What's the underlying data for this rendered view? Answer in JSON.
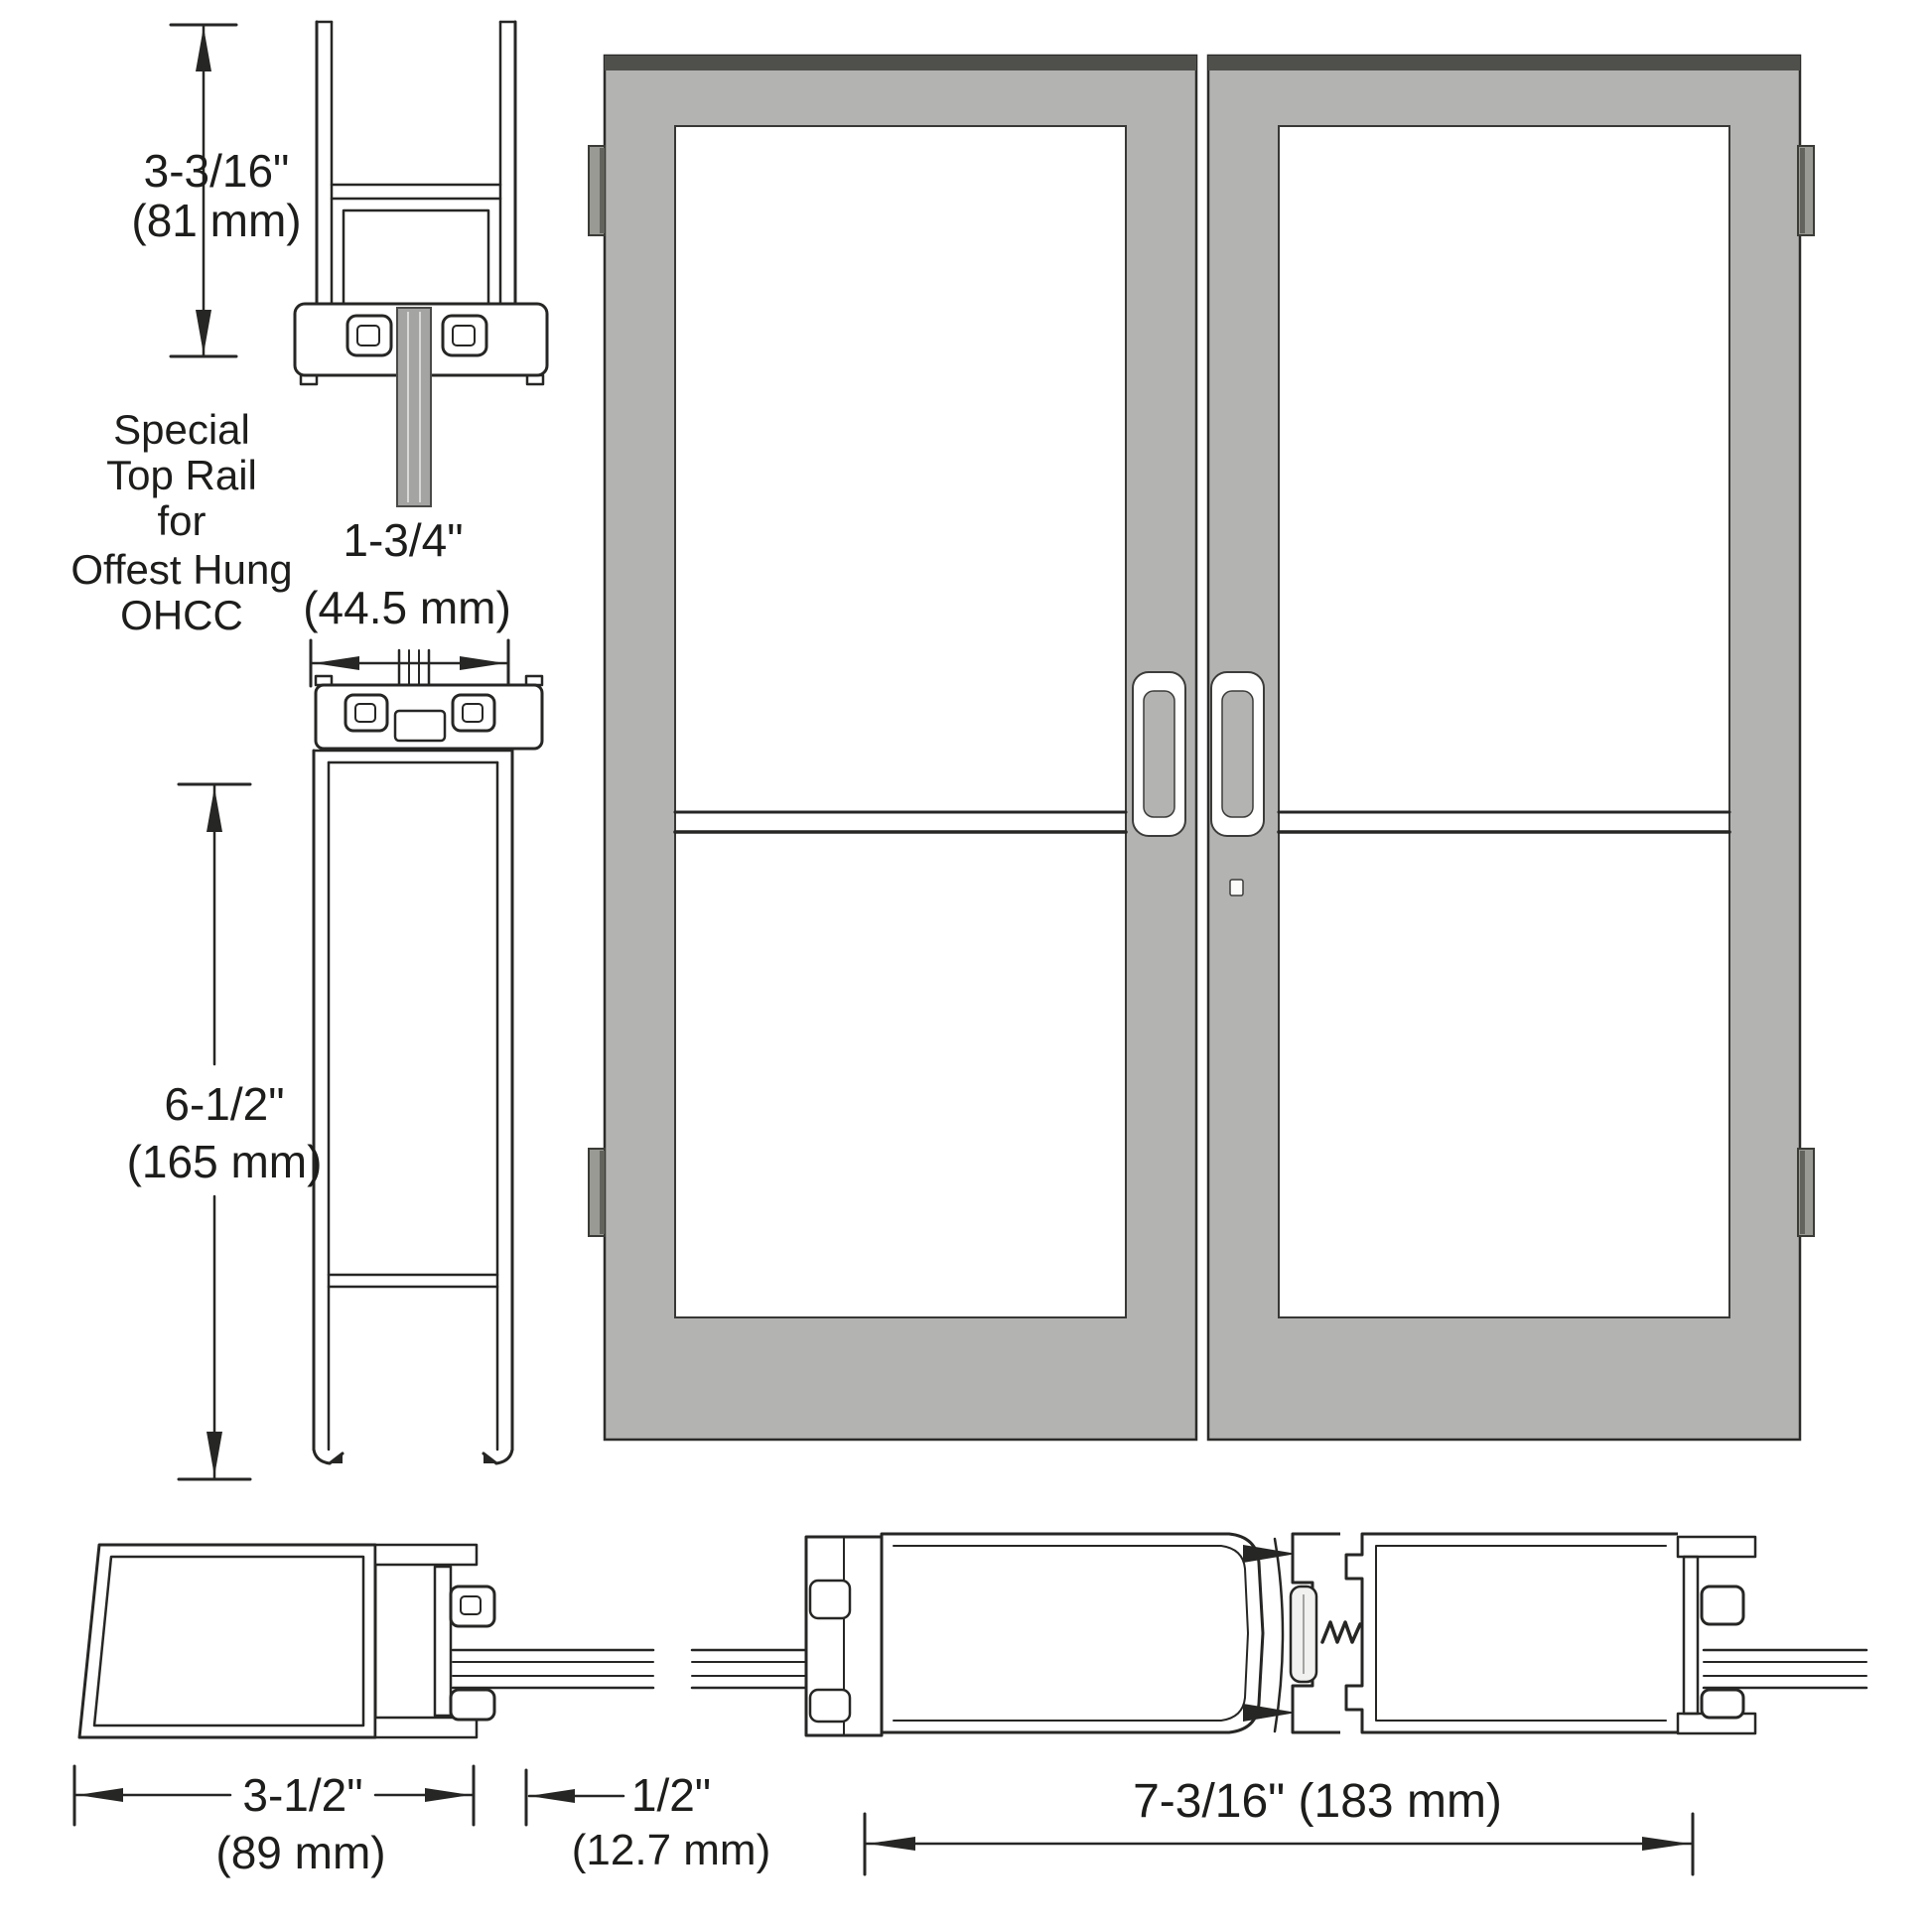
{
  "figure": {
    "title_implicit": "Commercial double door elevation with rail and stile cross sections",
    "top_rail_section": {
      "height_dim": {
        "inches": "3-3/16\"",
        "metric": "(81 mm)"
      },
      "caption_lines": [
        "Special",
        "Top Rail",
        "for",
        "Offest Hung",
        "OHCC"
      ],
      "thickness_dim": {
        "inches": "1-3/4\"",
        "metric": "(44.5 mm)"
      }
    },
    "bottom_rail_section": {
      "height_dim": {
        "inches": "6-1/2\"",
        "metric": "(165 mm)"
      }
    },
    "hinge_stile_section": {
      "width_dim": {
        "inches": "3-1/2\"",
        "metric": "(89 mm)"
      }
    },
    "gap_dim": {
      "inches": "1/2\"",
      "metric": "(12.7 mm)"
    },
    "meeting_stiles_section": {
      "width_dim_combined": "7-3/16\" (183 mm)"
    },
    "colors": {
      "door_fill": "#b3b3b1",
      "door_top_edge": "#4f4f4c",
      "hinge_fill": "#9a9a94",
      "glass_strip": "#a4a4a2",
      "line": "#262624"
    }
  }
}
